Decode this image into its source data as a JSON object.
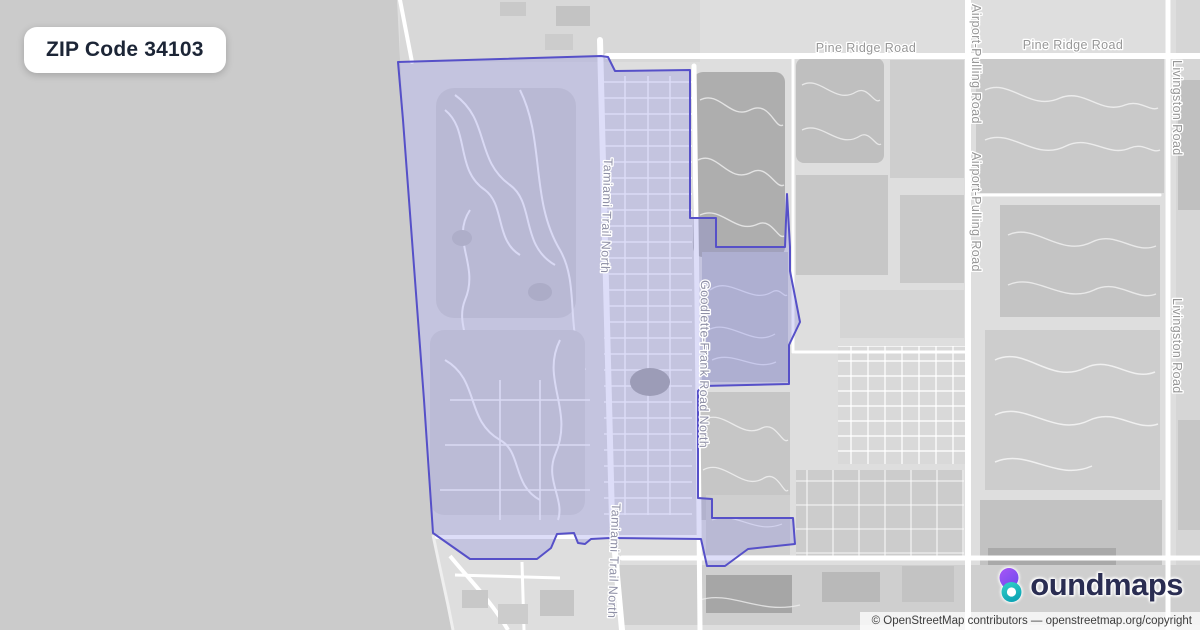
{
  "badge": {
    "label": "ZIP Code 34103"
  },
  "map": {
    "labels": [
      {
        "name": "pine-ridge-road-label-1",
        "text": "Pine Ridge Road"
      },
      {
        "name": "pine-ridge-road-label-2",
        "text": "Pine Ridge Road"
      },
      {
        "name": "airport-pulling-road-label-1",
        "text": "Airport-Pulling Road"
      },
      {
        "name": "airport-pulling-road-label-2",
        "text": "Airport-Pulling Road"
      },
      {
        "name": "livingston-road-label-1",
        "text": "Livingston Road"
      },
      {
        "name": "livingston-road-label-2",
        "text": "Livingston Road"
      },
      {
        "name": "tamiami-trail-label-1",
        "text": "Tamiami Trail North"
      },
      {
        "name": "tamiami-trail-label-2",
        "text": "Tamiami Trail North"
      },
      {
        "name": "goodlette-frank-label",
        "text": "Goodlette-Frank Road North"
      }
    ],
    "colors": {
      "boundary_stroke": "#5650c8",
      "boundary_fill": "rgba(122,124,229,0.26)",
      "water": "#cbcbcb",
      "land": "#dedede",
      "road": "#ffffff",
      "label_gray": "#979797"
    }
  },
  "logo": {
    "brand": "boundmaps",
    "wordmark_rest": "oundmaps"
  },
  "attribution": {
    "text": "© OpenStreetMap contributors — openstreetmap.org/copyright"
  }
}
